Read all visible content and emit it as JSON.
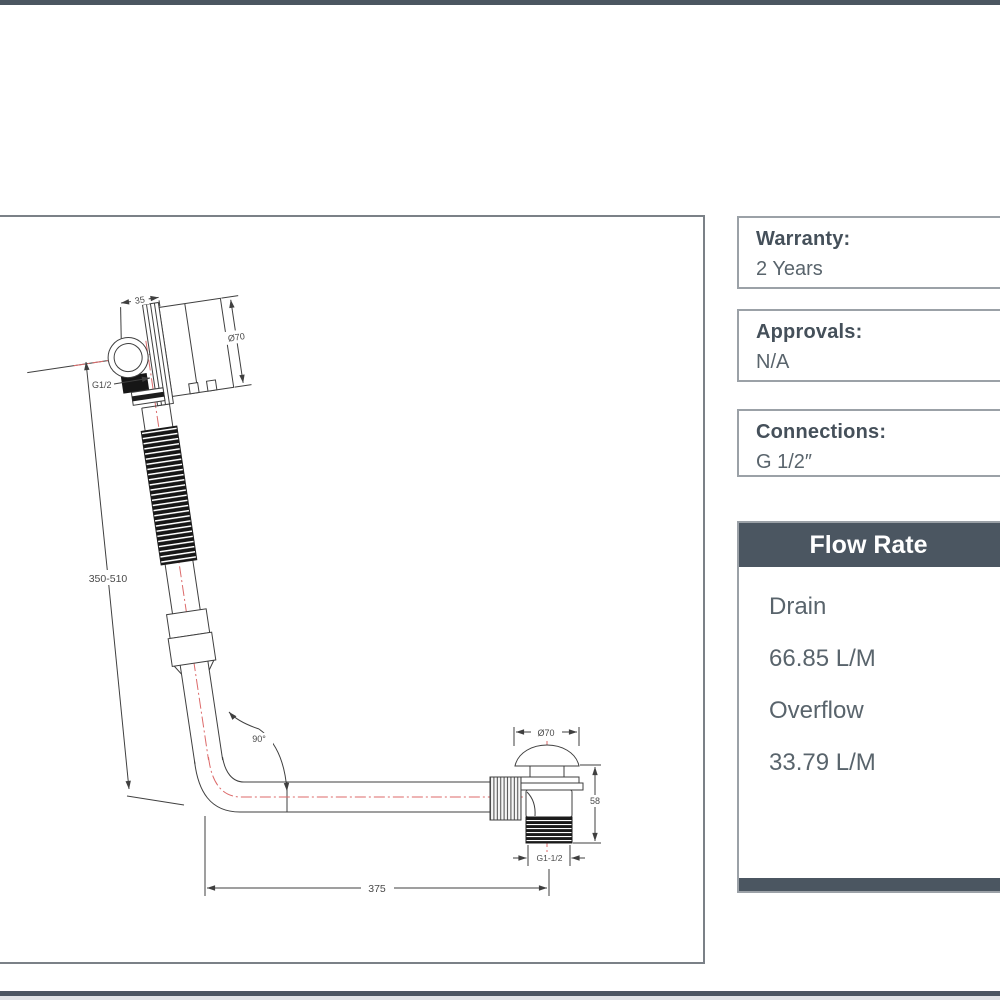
{
  "colors": {
    "accent_slate": "#4b5661",
    "box_border": "#9ba1a7",
    "centerline_red": "#dc6a6a",
    "line_dark": "#3f3f3f"
  },
  "specs": [
    {
      "label": "Warranty:",
      "value": "2 Years"
    },
    {
      "label": "Approvals:",
      "value": "N/A"
    },
    {
      "label": "Connections:",
      "value": "G 1/2″"
    }
  ],
  "flow_rate": {
    "title": "Flow Rate",
    "rows": [
      {
        "label": "Drain",
        "value": "66.85 L/M"
      },
      {
        "label": "Overflow",
        "value": "33.79 L/M"
      }
    ]
  },
  "drawing": {
    "dims": {
      "overflow_width": "35",
      "overflow_diameter": "Ø70",
      "overflow_thread": "G1/2",
      "riser_length": "350-510",
      "bend_angle": "90°",
      "run_length": "375",
      "drain_diameter": "Ø70",
      "drain_height": "58",
      "drain_thread": "G1-1/2"
    }
  }
}
